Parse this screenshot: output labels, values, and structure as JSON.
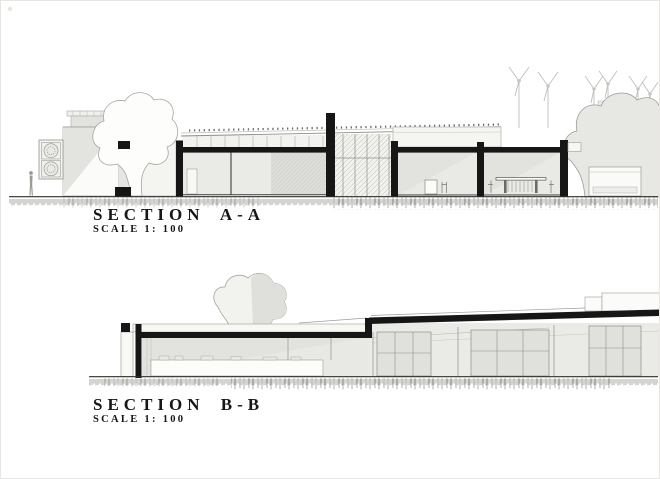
{
  "sheet": {
    "background_color": "#ffffff",
    "ink_color": "#161616",
    "cut_black": "#161616",
    "fill_light_gray": "#eaeae7",
    "fill_mid_gray": "#dfdfdb",
    "line_gray": "#9c9c98"
  },
  "section_a": {
    "title": "SECTION A-A",
    "scale_label": "SCALE 1: 100"
  },
  "section_b": {
    "title": "SECTION B-B",
    "scale_label": "SCALE 1: 100"
  }
}
